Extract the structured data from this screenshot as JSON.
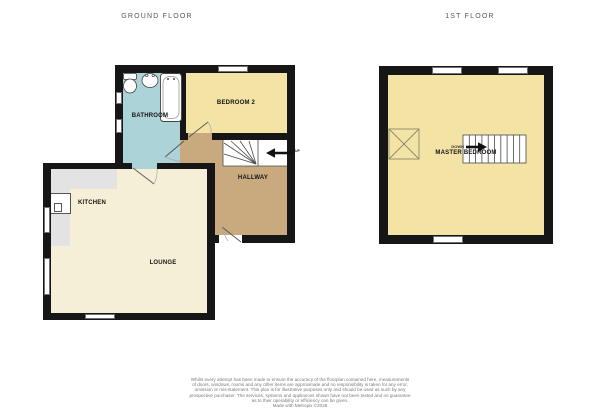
{
  "titles": {
    "ground": "GROUND FLOOR",
    "first": "1ST FLOOR"
  },
  "ground_floor": {
    "rooms": {
      "bathroom": "BATHROOM",
      "bedroom2": "BEDROOM 2",
      "hallway": "HALLWAY",
      "kitchen": "KITCHEN",
      "lounge": "LOUNGE"
    },
    "stair_direction": "UP"
  },
  "first_floor": {
    "rooms": {
      "master_bedroom": "MASTER BEDROOM"
    },
    "stair_direction": "DOWN"
  },
  "disclaimer": {
    "lines": [
      "Whilst every attempt has been made to ensure the accuracy of the floorplan contained here, measurements",
      "of doors, windows, rooms and any other items are approximate and no responsibility is taken for any error,",
      "omission or mis-statement. This plan is for illustrative purposes only and should be used as such by any",
      "prospective purchaser. The services, systems and appliances shown have not been tested and no guarantee",
      "as to their operability or efficiency can be given.",
      "Made with Metropix ©2025"
    ]
  },
  "colors": {
    "wall": "#161616",
    "bathroom": "#abd3d8",
    "bedroom_yellow": "#f3e3a4",
    "hallway_tan": "#c8aa7e",
    "lounge_cream": "#f5efd7",
    "counter_gray": "#e3e3e3"
  }
}
